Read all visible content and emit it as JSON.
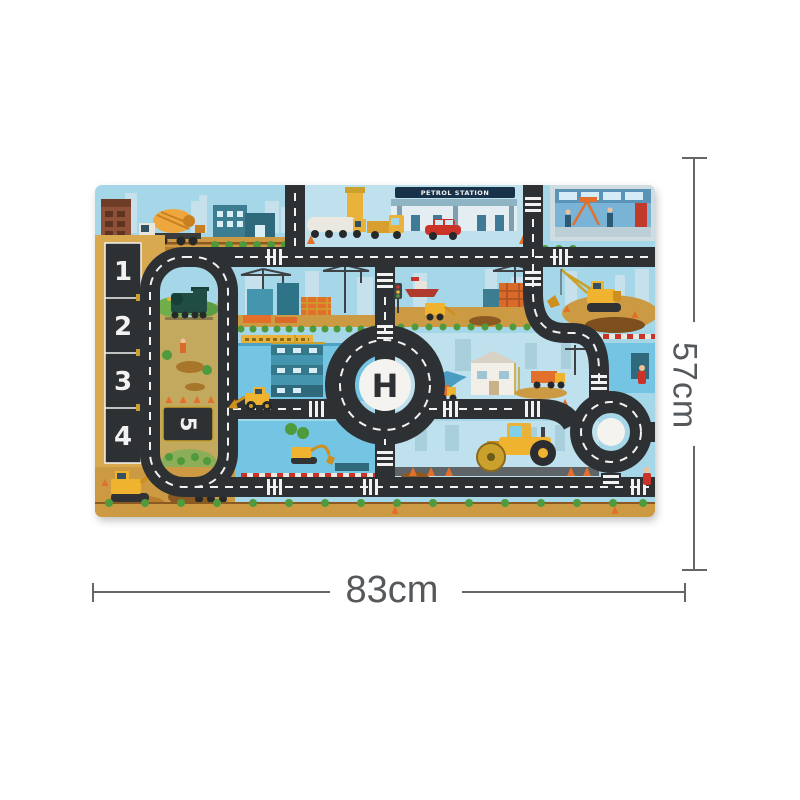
{
  "scene": {
    "type": "product-photo-of-play-mat",
    "background": "#ffffff"
  },
  "dimensions": {
    "height_label": "57cm",
    "width_label": "83cm"
  },
  "mat": {
    "signs": {
      "petrol_station": "PETROL STATION"
    },
    "helipad_letter": "H",
    "parking_spots": [
      "1",
      "2",
      "3",
      "4"
    ],
    "side_parking_spot": "5",
    "colors": {
      "road": "#2e3134",
      "road_marking": "#f2f2f2",
      "sky": "#a6d7e8",
      "scene_sky": "#bfe0ed",
      "dirt": "#cd9a44",
      "dirt_dark": "#8a5a22",
      "water": "#74c4e4",
      "grass": "#4e9a3c",
      "machine_yellow": "#efb32f",
      "machine_yellow_dark": "#cf8f1f",
      "orange": "#e2702a",
      "red": "#cc3328",
      "teal": "#3d8ba1",
      "dimension_line": "#63676a"
    }
  }
}
